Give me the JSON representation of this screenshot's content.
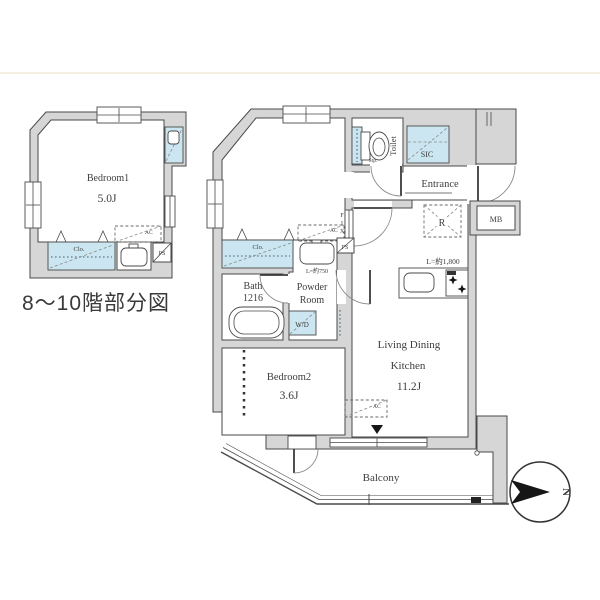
{
  "plan": {
    "caption": "8〜10階部分図",
    "small": {
      "bedroom1": "Bedroom1",
      "bedroom1_size": "5.0J",
      "closet": "Clo.",
      "ac": "AC",
      "ps": "PS"
    },
    "main": {
      "bedroom1": "Bedroom1",
      "bedroom1_size": "5.0J",
      "bedroom2": "Bedroom2",
      "bedroom2_size": "3.6J",
      "ldk_line1": "Living Dining",
      "ldk_line2": "Kitchen",
      "ldk_size": "11.2J",
      "bath": "Bath",
      "bath_size": "1216",
      "powder_line1": "Powder",
      "powder_line2": "Room",
      "toilet": "Toilet",
      "stp": "Stp.",
      "sic": "SIC",
      "entrance": "Entrance",
      "wd": "W/D",
      "mb": "MB",
      "refrigerator": "R",
      "fix": [
        "F",
        "I",
        "X"
      ],
      "ps": "PS",
      "closet": "Clo.",
      "ac": "AC",
      "counter_750": "L=約750",
      "counter_1800": "L=約1,800",
      "balcony": "Balcony"
    },
    "compass": {
      "north": "N"
    }
  }
}
